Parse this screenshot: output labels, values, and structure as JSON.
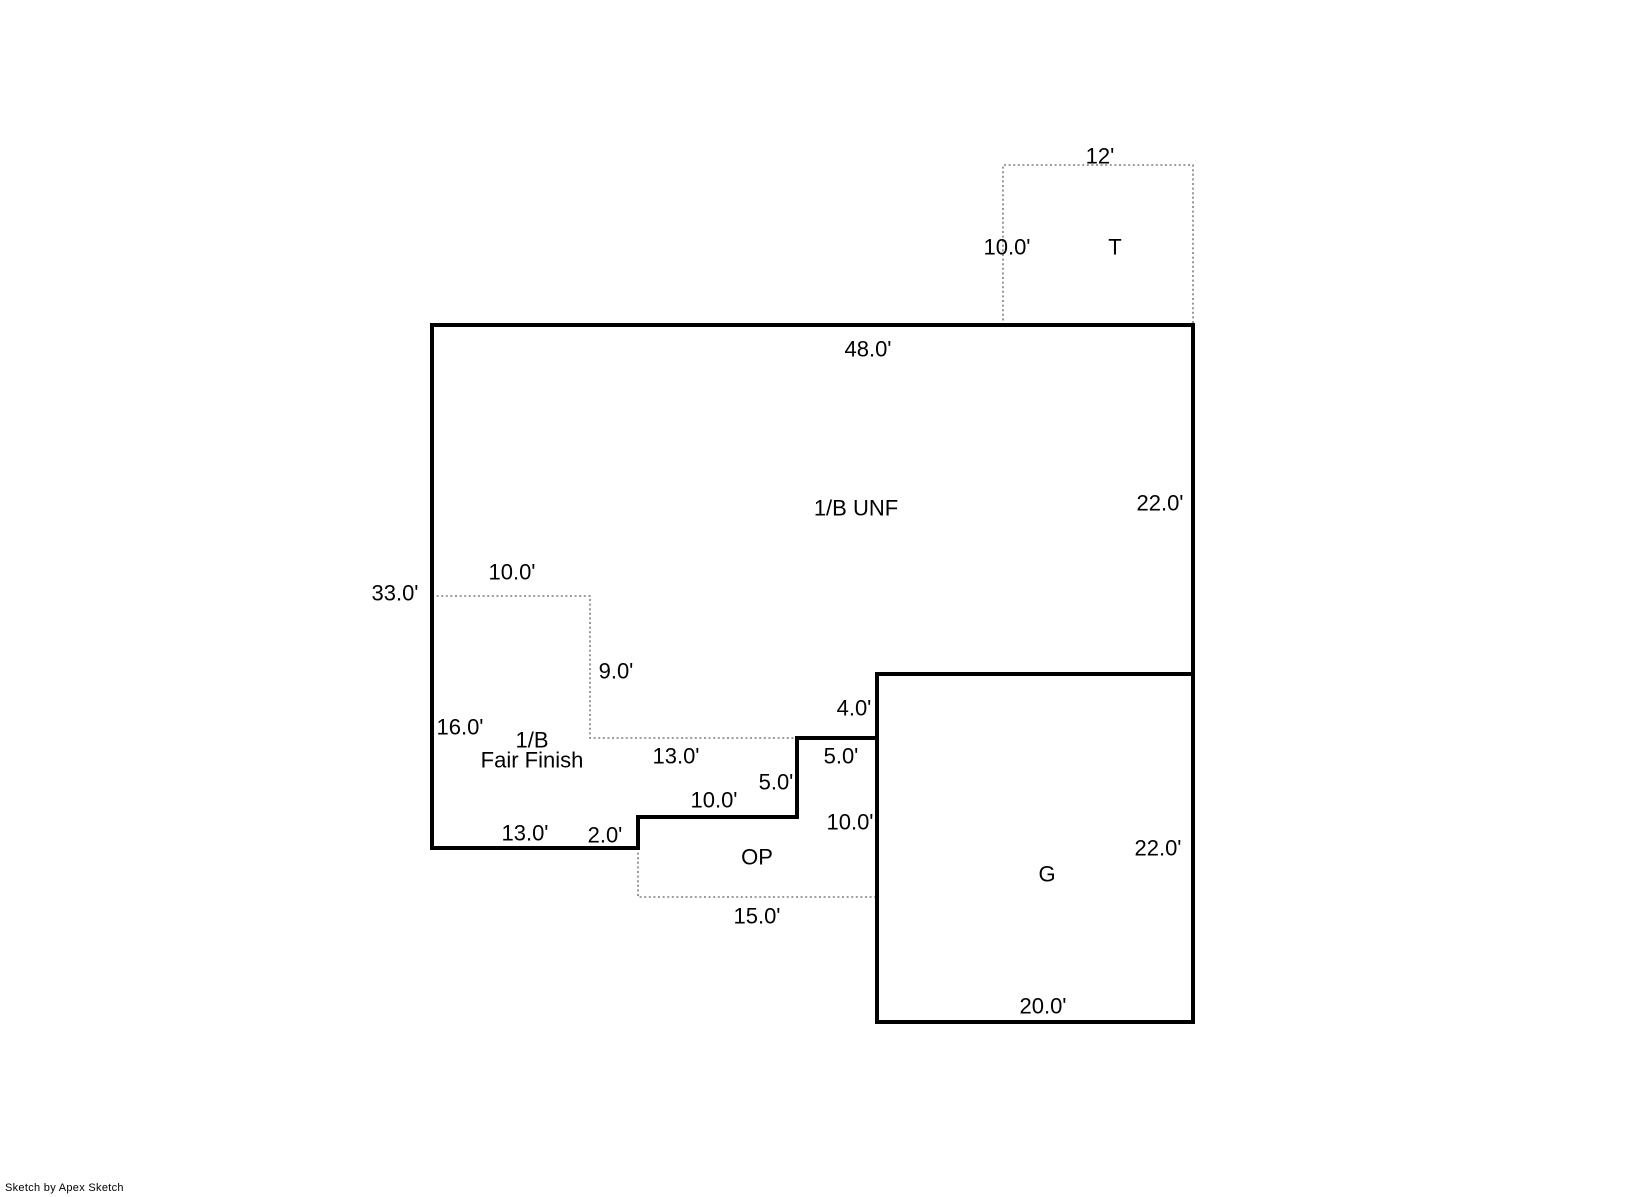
{
  "page": {
    "width": 1632,
    "height": 1197,
    "background": "#ffffff"
  },
  "plan": {
    "colors": {
      "wall": "#000000",
      "dotted": "#7f7f7f",
      "text": "#000000"
    },
    "solid_paths": [
      {
        "name": "house-outline",
        "closed": true,
        "points": [
          [
            432,
            325
          ],
          [
            1193,
            325
          ],
          [
            1193,
            674
          ],
          [
            877,
            674
          ],
          [
            877,
            738
          ],
          [
            797,
            738
          ],
          [
            797,
            817
          ],
          [
            638,
            817
          ],
          [
            638,
            848
          ],
          [
            432,
            848
          ]
        ]
      },
      {
        "name": "garage-outline",
        "closed": true,
        "points": [
          [
            877,
            674
          ],
          [
            1193,
            674
          ],
          [
            1193,
            1022
          ],
          [
            877,
            1022
          ]
        ]
      }
    ],
    "dotted_paths": [
      {
        "name": "tank-outline",
        "closed": false,
        "points": [
          [
            1003,
            325
          ],
          [
            1003,
            165
          ],
          [
            1193,
            165
          ],
          [
            1193,
            325
          ]
        ]
      },
      {
        "name": "fair-finish-divider",
        "closed": false,
        "points": [
          [
            432,
            596
          ],
          [
            590,
            596
          ],
          [
            590,
            738
          ],
          [
            797,
            738
          ]
        ]
      },
      {
        "name": "open-porch-outline",
        "closed": false,
        "points": [
          [
            638,
            848
          ],
          [
            638,
            897
          ],
          [
            877,
            897
          ]
        ]
      }
    ],
    "area_labels": [
      {
        "name": "area-label-unf",
        "lines": [
          "1/B UNF"
        ],
        "x": 856,
        "y": 508,
        "line_height": 20
      },
      {
        "name": "area-label-fair-finish",
        "lines": [
          "1/B",
          "Fair Finish"
        ],
        "x": 532,
        "y": 750,
        "line_height": 20
      },
      {
        "name": "area-label-open-porch",
        "lines": [
          "OP"
        ],
        "x": 757,
        "y": 857,
        "line_height": 20
      },
      {
        "name": "area-label-garage",
        "lines": [
          "G"
        ],
        "x": 1047,
        "y": 874,
        "line_height": 20
      },
      {
        "name": "area-label-tank",
        "lines": [
          "T"
        ],
        "x": 1115,
        "y": 247,
        "line_height": 20
      }
    ],
    "dimension_labels": [
      {
        "text": "48.0'",
        "x": 868,
        "y": 349
      },
      {
        "text": "22.0'",
        "x": 1160,
        "y": 503
      },
      {
        "text": "12'",
        "x": 1100,
        "y": 156
      },
      {
        "text": "10.0'",
        "x": 1007,
        "y": 247
      },
      {
        "text": "33.0'",
        "x": 395,
        "y": 593
      },
      {
        "text": "10.0'",
        "x": 512,
        "y": 572
      },
      {
        "text": "9.0'",
        "x": 616,
        "y": 671
      },
      {
        "text": "16.0'",
        "x": 460,
        "y": 727
      },
      {
        "text": "13.0'",
        "x": 676,
        "y": 756
      },
      {
        "text": "4.0'",
        "x": 854,
        "y": 708
      },
      {
        "text": "5.0'",
        "x": 841,
        "y": 756
      },
      {
        "text": "5.0'",
        "x": 776,
        "y": 782
      },
      {
        "text": "10.0'",
        "x": 714,
        "y": 800
      },
      {
        "text": "2.0'",
        "x": 605,
        "y": 835
      },
      {
        "text": "13.0'",
        "x": 525,
        "y": 833
      },
      {
        "text": "10.0'",
        "x": 850,
        "y": 822
      },
      {
        "text": "15.0'",
        "x": 757,
        "y": 916
      },
      {
        "text": "22.0'",
        "x": 1158,
        "y": 848
      },
      {
        "text": "20.0'",
        "x": 1043,
        "y": 1006
      }
    ]
  },
  "footer": {
    "credit": "Sketch by Apex Sketch"
  }
}
